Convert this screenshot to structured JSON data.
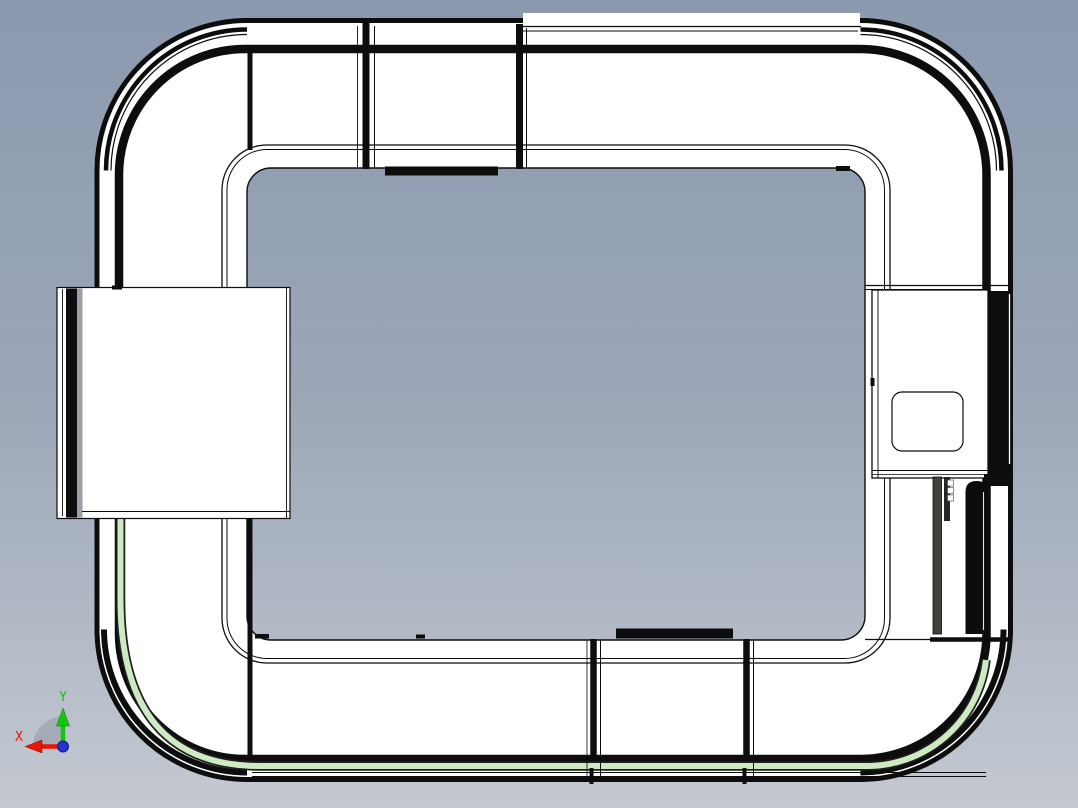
{
  "scene": {
    "description": "CAD viewport - top view of a rectangular pallet conveyor loop assembly with corner curve units, straight conveyor segments, a left-side station block and a right-side drive station"
  },
  "viewport": {
    "bg_top": "#8b99af",
    "bg_mid": "#9ca7b8",
    "bg_bottom": "#c4c9d1",
    "outline": "#0d0d0d",
    "surface": "#ffffff",
    "guide_strip": "#cdeac3",
    "guide_edge": "#1f1f1f",
    "dark_bar": "#3f423b",
    "dark_bar2": "#24261f",
    "block_gray": "#9aa1a9"
  },
  "triad": {
    "x_label": "X",
    "y_label": "Y",
    "x_color": "#e81404",
    "y_color": "#12c70e",
    "z_dot_color": "#2433cf",
    "sector_color": "#a3aab5"
  }
}
